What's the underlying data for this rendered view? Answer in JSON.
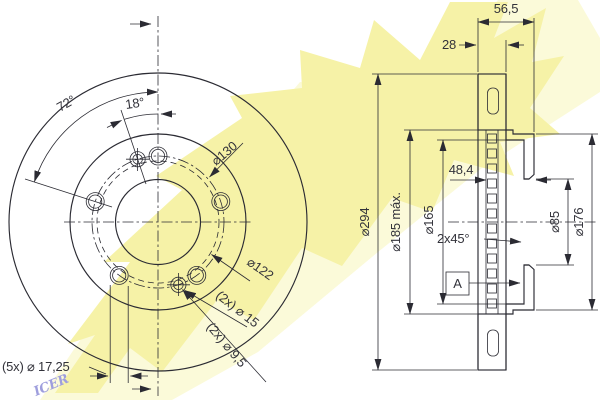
{
  "watermark": {
    "brand": "ICER",
    "letter_color": "#9e9edd",
    "band_color": "#f6f2a7",
    "band_light_color": "#fbfad9"
  },
  "drawing": {
    "line_color": "#2b2b33",
    "views": [
      "front-view",
      "section-view"
    ]
  },
  "front": {
    "angle72": "72°",
    "angle18": "18°",
    "bolt_circle": "⌀130",
    "d122": "⌀122",
    "pin15": "(2x) ⌀ 15",
    "pin95": "(2x) ⌀ 9,5",
    "bolt_holes": "(5x) ⌀ 17,25"
  },
  "section": {
    "height": "56,5",
    "friction": "28",
    "hat_depth": "48,4",
    "outer": "⌀294",
    "hat_max": "⌀185 máx.",
    "cavity": "⌀165",
    "bore": "⌀85",
    "flange": "⌀176",
    "chamfer": "2x45°",
    "detail": "A"
  }
}
